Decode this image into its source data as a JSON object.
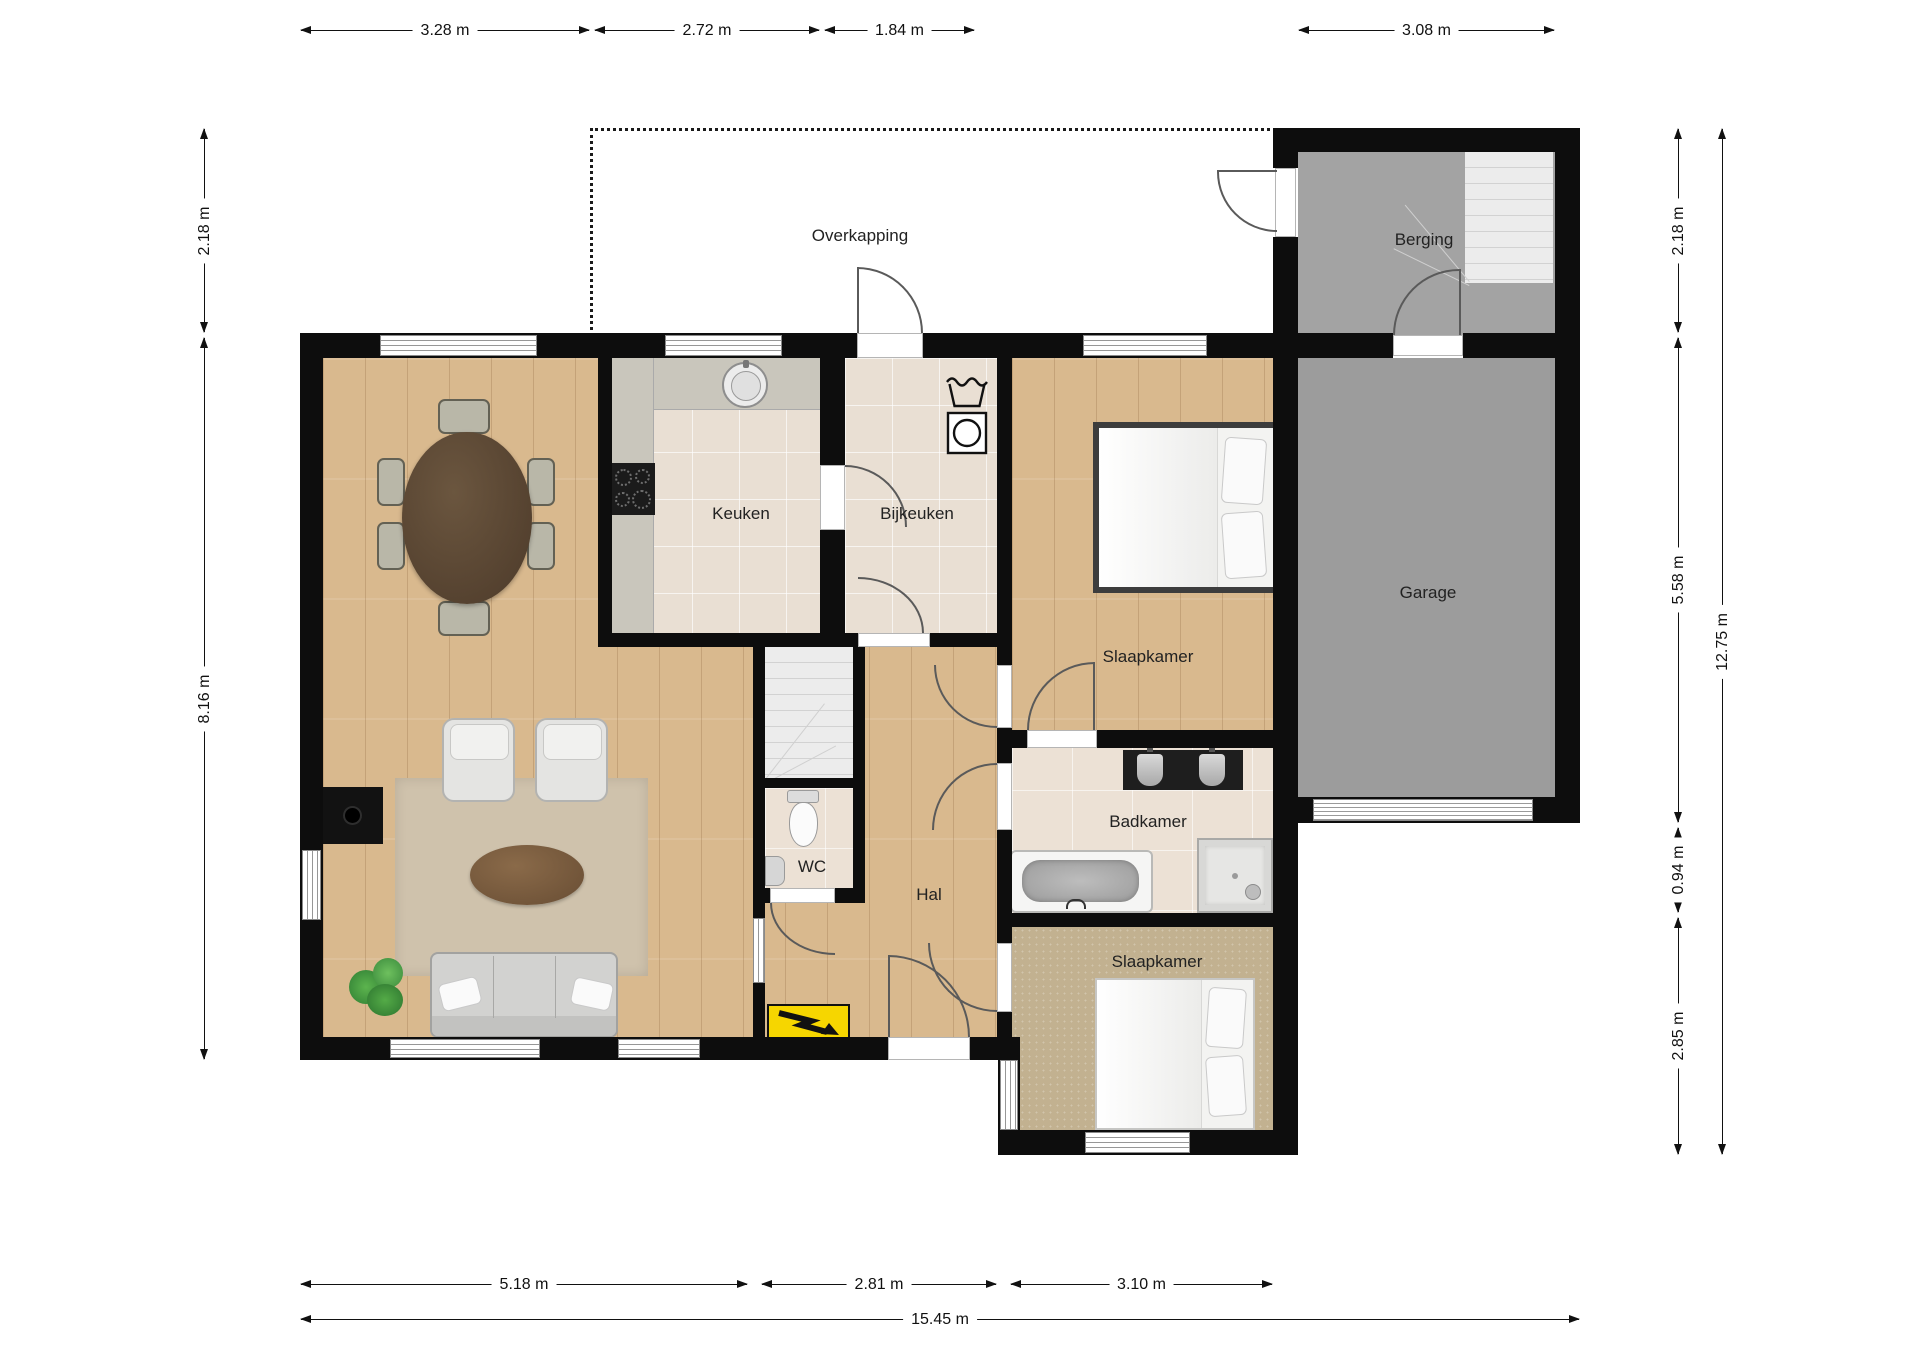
{
  "plan_title": "Begane grond plattegrond",
  "rooms": {
    "overkapping": "Overkapping",
    "berging": "Berging",
    "garage": "Garage",
    "keuken": "Keuken",
    "bijkeuken": "Bijkeuken",
    "slaapkamer_top": "Slaapkamer",
    "badkamer": "Badkamer",
    "wc": "WC",
    "hal": "Hal",
    "slaapkamer_bottom": "Slaapkamer"
  },
  "dimensions": {
    "top": [
      "3.28 m",
      "2.72 m",
      "1.84 m",
      "3.08 m"
    ],
    "bottom_segments": [
      "5.18 m",
      "2.81 m",
      "3.10 m"
    ],
    "bottom_total": "15.45 m",
    "left": [
      "2.18 m",
      "8.16 m"
    ],
    "right": [
      "2.18 m",
      "5.58 m",
      "0.94 m",
      "2.85 m"
    ],
    "right_total": "12.75 m"
  },
  "colors": {
    "wall": "#0d0d0d",
    "wood": "#d9b98e",
    "tile": "#e9dfd3",
    "tilebath": "#ece1d5",
    "counter": "#c9c6bc",
    "bergingf": "#a3a3a3",
    "garagef": "#9c9c9c",
    "carpet": "#c2b190",
    "rug": "#cfc2ac",
    "warn": "#f6d600"
  },
  "icons": [
    "washtub-icon",
    "washing-machine-icon",
    "sink-icon",
    "cooktop-icon",
    "toilet-icon",
    "bathtub-icon",
    "shower-icon",
    "double-washbasin-icon",
    "electric-meter-icon",
    "plant-icon",
    "fireplace-icon",
    "stairs-icon"
  ]
}
